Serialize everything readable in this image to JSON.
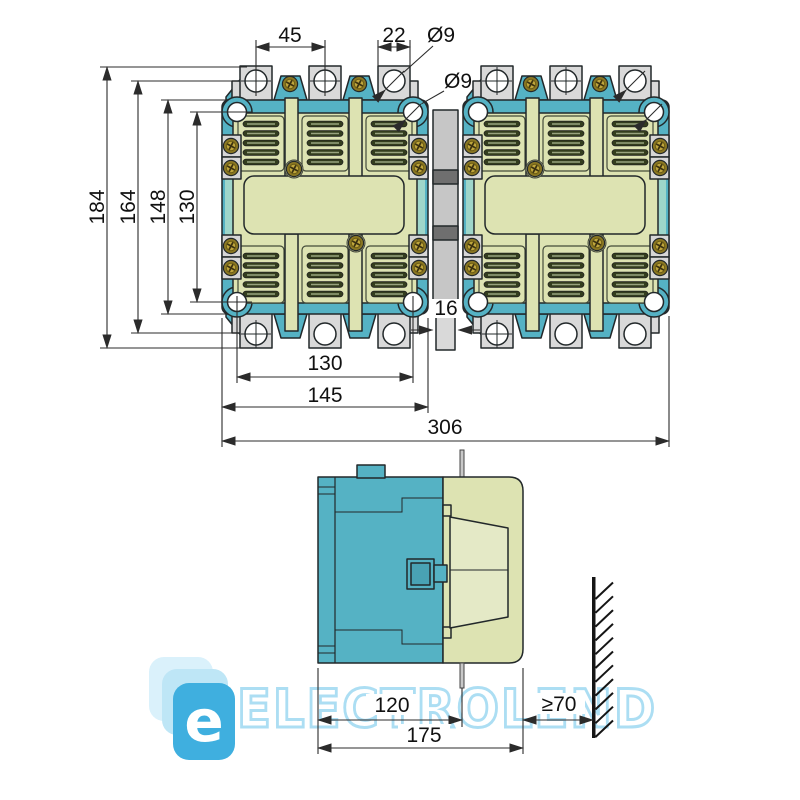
{
  "front_view": {
    "dim_terminal_pitch": "45",
    "dim_terminal_width": "22",
    "dim_terminal_hole": "Ø9",
    "dim_mounting_hole": "Ø9",
    "dim_total_height": "184",
    "dim_step_height": "164",
    "dim_frame_height": "148",
    "dim_mounting_height": "130",
    "dim_link_width": "16",
    "dim_mounting_width": "130",
    "dim_unit_width": "145",
    "dim_total_width": "306"
  },
  "side_view": {
    "dim_mounting_depth": "120",
    "dim_total_depth": "175",
    "dim_wall_clearance": "≥70"
  },
  "watermark": {
    "logo_letter": "e",
    "brand": "ELECTROLEND"
  },
  "colors": {
    "teal": "#55b2c4",
    "teal_light": "#9fd6ca",
    "beige": "#dde3b2",
    "beige_light": "#e4e9c6",
    "slot_dark": "#333d1e",
    "slot_line": "#98a37e",
    "terminal_gray": "#d9d9d9",
    "link_gray": "#c6c6c6",
    "link_dark": "#6f6f6f",
    "brass": "#8a7722",
    "brass_light": "#c0a73d",
    "outline": "#22282a",
    "dimension": "#2b2b2b",
    "watermark_tile": "#2fa9dd",
    "watermark_tile_light": "#b9e4f6",
    "watermark_text": "#a6dcf3"
  }
}
